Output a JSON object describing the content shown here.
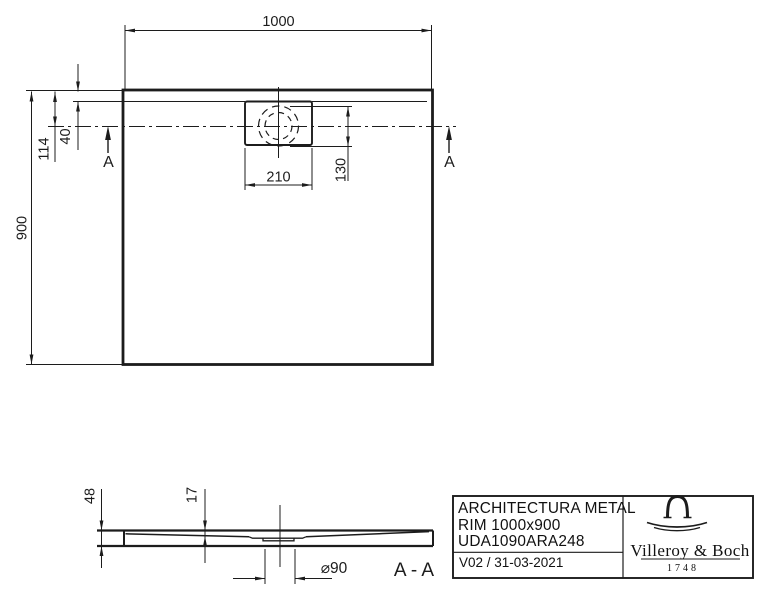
{
  "top_view": {
    "dim_width": "1000",
    "dim_height": "900",
    "dim_center_offset": "114",
    "dim_rim_inset": "40",
    "dim_drain_box_width": "210",
    "dim_drain_flange": "130",
    "section_marker_left": "A",
    "section_marker_right": "A"
  },
  "section_view": {
    "dim_total_height": "48",
    "dim_edge_thickness": "17",
    "dim_drain_diameter": "⌀90",
    "section_label": "A - A"
  },
  "title_block": {
    "product_name": "ARCHITECTURA METAL",
    "product_rim": "RIM 1000x900",
    "product_code": "UDA1090ARA248",
    "revision": "V02 / 31-03-2021",
    "brand_name": "Villeroy & Boch",
    "brand_year": "1748"
  },
  "colors": {
    "ink": "#1c1c1c",
    "background": "#ffffff"
  }
}
